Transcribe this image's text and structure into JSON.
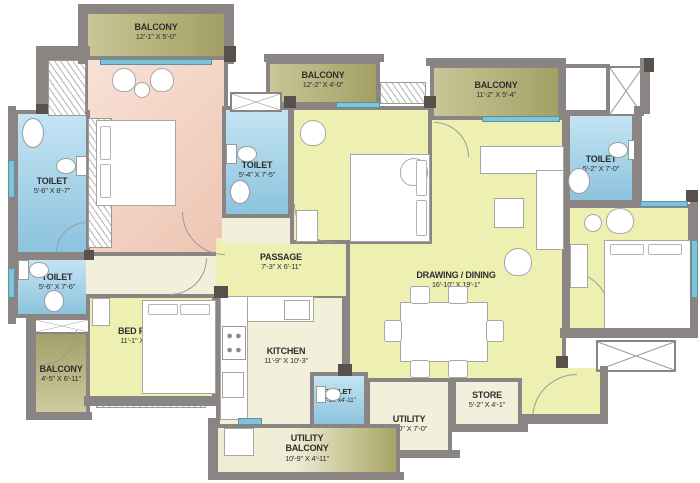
{
  "plan_title": "apartment-floor-plan",
  "colors": {
    "wall": "#8a8482",
    "wall_dark": "#57504d",
    "balcony_olive": "#a3a065",
    "master_pink": "#eec4b2",
    "room_yellow": "#eef0b2",
    "utility_cream": "#f2efda",
    "toilet_blue": "#8cc3de",
    "window_sill": "#7ec3d8"
  },
  "rooms": [
    {
      "name": "BALCONY",
      "dims": "12'-1\" X 5'-0\""
    },
    {
      "name": "MASTER BEDROOM",
      "dims": "11'-1\" X 15'-6\""
    },
    {
      "name": "TOILET",
      "dims": "5'-6\" X 8'-7\""
    },
    {
      "name": "TOILET",
      "dims": "5'-6\" X 7'-6\""
    },
    {
      "name": "BALCONY",
      "dims": "4'-5\" X 6'-11\""
    },
    {
      "name": "BED ROOM",
      "dims": "11'-1\" X 13'-1\""
    },
    {
      "name": "KITCHEN",
      "dims": "11'-9\" X 10'-3\""
    },
    {
      "name": "PASSAGE",
      "dims": "7'-3\" X 6'-11\""
    },
    {
      "name": "TOILET",
      "dims": "5'-4\" X 7'-5\""
    },
    {
      "name": "BALCONY",
      "dims": "12'-2\" X 4'-0\""
    },
    {
      "name": "BED ROOM",
      "dims": "11'-1\" X 12'-1\""
    },
    {
      "name": "BALCONY",
      "dims": "11'-2\" X 5'-4\""
    },
    {
      "name": "TOILET",
      "dims": "5'-2\" X 7'-0\""
    },
    {
      "name": "BED ROOM",
      "dims": "10'-1\" X 11'-2\""
    },
    {
      "name": "DRAWING / DINING",
      "dims": "16'-10\" X 19'-1\""
    },
    {
      "name": "TOILET",
      "dims": "3'-10\"x4'-11\""
    },
    {
      "name": "UTILITY",
      "dims": "8'-0\" X 7'-0\""
    },
    {
      "name": "STORE",
      "dims": "5'-2\" X 4'-1\""
    },
    {
      "name": "UTILITY BALCONY",
      "dims": "10'-9\" X 4'-11\""
    }
  ]
}
